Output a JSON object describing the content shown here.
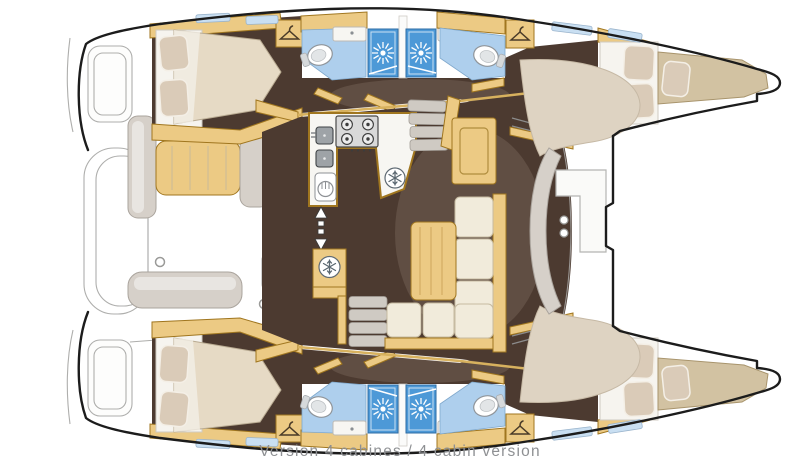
{
  "caption": {
    "text": "Version 4 cabines / 4 cabin version"
  },
  "colors": {
    "hull_outline": "#1c1c1c",
    "deck_line": "#aeaeac",
    "wood": "#ecca84",
    "wood_edge": "#a0761f",
    "floor": "#4c3a30",
    "bath_floor": "#aecfed",
    "shower_blue": "#4d99d7",
    "counter": "#f7f6f2",
    "upholstery": "#f1ebdb",
    "mattress": "#e6dac5",
    "pillow": "#dacbb8",
    "bow_berth": "#d2c2a2",
    "seat_gray": "#d6d0c9",
    "hatch_blue": "#c9dff2",
    "mat_khaki": "#a3926f",
    "stove_gray": "#d9d9d9",
    "beige_deck": "#ded3c2",
    "caption_gray": "#8e9093"
  },
  "icons": {
    "shower_icon": "sunburst",
    "wardrobe_icon": "clothes-hanger",
    "refrigerator_icon": "snowflake",
    "stove_icon": "four-burner-cooktop",
    "sink_icon": "basin",
    "toilet_icon": "toilet-bowl",
    "companionway_icon": "double-headed-arrow",
    "deck_hatch_icon": "skylight"
  }
}
